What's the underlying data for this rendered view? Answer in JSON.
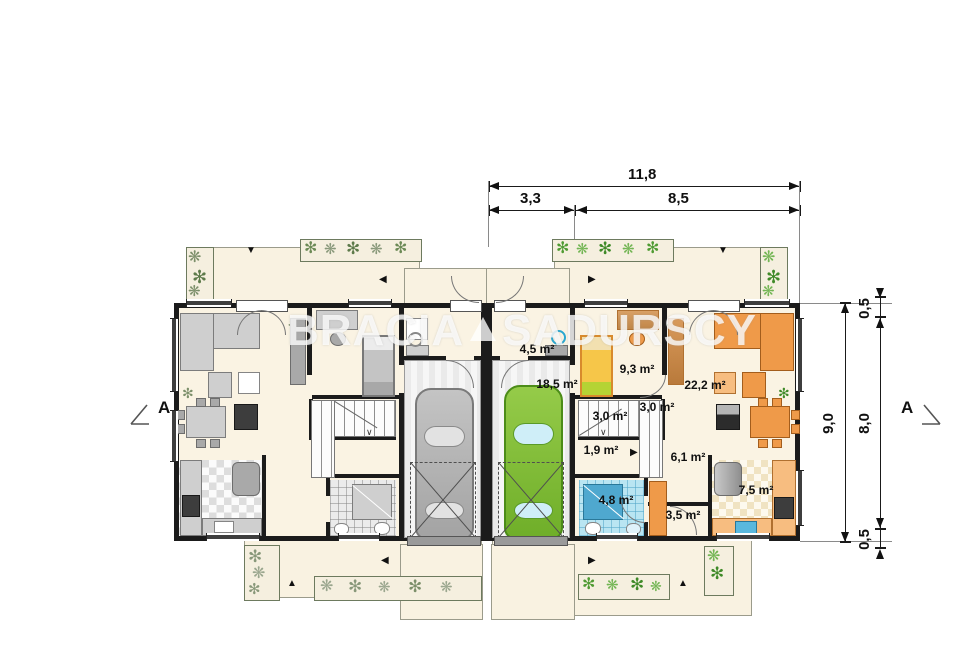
{
  "watermark": {
    "left": "BRACIA",
    "right": "SADURSCY"
  },
  "dimensions": {
    "top_total": "11,8",
    "top_seg_left": "3,3",
    "top_seg_right": "8,5",
    "side_total": "9,0",
    "side_top": "0,5",
    "side_mid": "8,0",
    "side_bottom": "0,5"
  },
  "section_markers": {
    "left": "A",
    "right": "A"
  },
  "rooms_right_unit": {
    "vestibule": "4,5 m²",
    "garage": "18,5 m²",
    "bedroom": "9,3 m²",
    "living": "22,2 m²",
    "stairs": "3,0 m²",
    "stairs_upper": "3,0 m²",
    "closet": "1,9 m²",
    "hall": "6,1 m²",
    "bathroom": "4,8 m²",
    "storage": "3,5 m²",
    "kitchen": "7,5 m²"
  },
  "colors": {
    "floor": "#faf3e3",
    "wall": "#1b1b1b",
    "car_left": "#b5b5b5",
    "car_right": "#7fbe3b",
    "bath_tile_blue": "#b9e5f2",
    "furniture_orange": "#ef9a49",
    "plant_green": "#4f8f33"
  }
}
